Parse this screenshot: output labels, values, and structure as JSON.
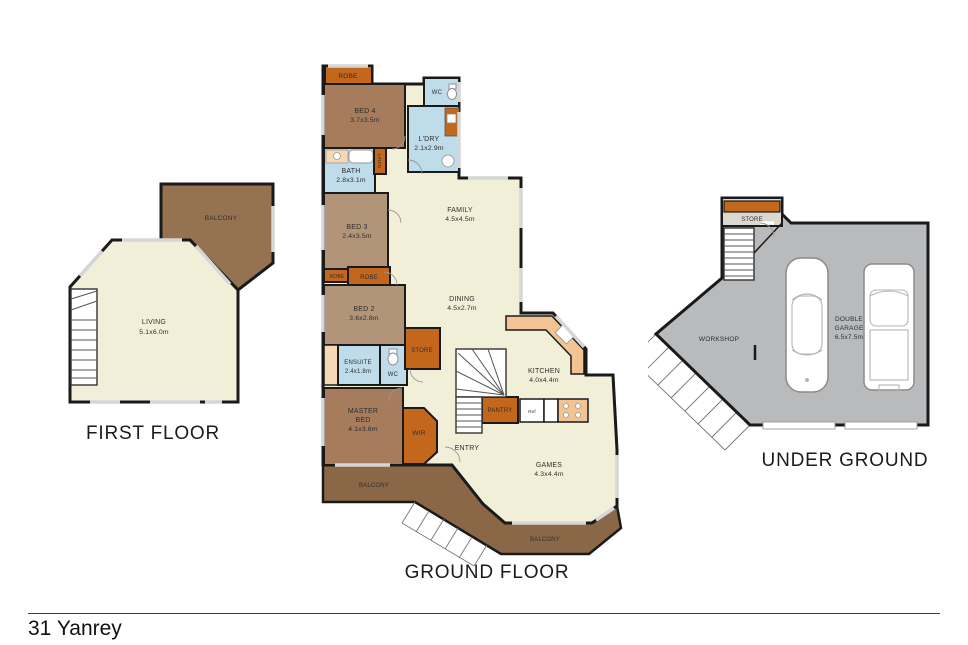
{
  "address": "31 Yanrey",
  "palette": {
    "wall": "#1a1a1a",
    "floor_cream": "#f2efd9",
    "bedroom_dark": "#a67c5d",
    "bedroom_light": "#b29478",
    "wet_area_blue": "#bedce9",
    "storage_orange": "#c2671c",
    "balcony_brown": "#8a6847",
    "balcony_brown_light": "#967350",
    "bench_peach": "#f2c494",
    "vanity_peach": "#f6d9b4",
    "garage_grey": "#b8babc",
    "window_grey": "#d6d6d6"
  },
  "floors": {
    "first": {
      "label": "FIRST FLOOR",
      "rooms": {
        "balcony": {
          "name": "BALCONY"
        },
        "living": {
          "name": "LIVING",
          "dims": "5.1x6.0m"
        }
      }
    },
    "ground": {
      "label": "GROUND FLOOR",
      "rooms": {
        "robe_top": {
          "name": "ROBE"
        },
        "bed4": {
          "name": "BED 4",
          "dims": "3.7x3.5m"
        },
        "wc_top": {
          "name": "WC"
        },
        "ldry": {
          "name": "L'DRY",
          "dims": "2.1x2.9m"
        },
        "bath": {
          "name": "BATH",
          "dims": "2.8x3.1m"
        },
        "linen": {
          "name": "LINEN"
        },
        "bed3": {
          "name": "BED 3",
          "dims": "2.4x3.5m"
        },
        "robe_left": {
          "name": "ROBE"
        },
        "robe_right": {
          "name": "ROBE"
        },
        "bed2": {
          "name": "BED 2",
          "dims": "3.6x2.8m"
        },
        "ensuite": {
          "name": "ENSUITE",
          "dims": "2.4x1.8m"
        },
        "wc": {
          "name": "WC"
        },
        "store": {
          "name": "STORE"
        },
        "family": {
          "name": "FAMILY",
          "dims": "4.5x4.5m"
        },
        "dining": {
          "name": "DINING",
          "dims": "4.5x2.7m"
        },
        "kitchen": {
          "name": "KITCHEN",
          "dims": "4.0x4.4m"
        },
        "pantry": {
          "name": "PANTRY"
        },
        "fridge": {
          "name": "Ref"
        },
        "master": {
          "line1": "MASTER",
          "line2": "BED",
          "dims": "4.1x3.6m"
        },
        "wir": {
          "name": "WIR"
        },
        "entry": {
          "name": "ENTRY"
        },
        "games": {
          "name": "GAMES",
          "dims": "4.3x4.4m"
        },
        "balcony_side": {
          "name": "BALCONY"
        },
        "balcony_rear": {
          "name": "BALCONY"
        }
      }
    },
    "underground": {
      "label": "UNDER GROUND",
      "rooms": {
        "store": {
          "name": "STORE"
        },
        "workshop": {
          "name": "WORKSHOP"
        },
        "garage": {
          "line1": "DOUBLE",
          "line2": "GARAGE",
          "dims": "6.5x7.5m"
        }
      }
    }
  }
}
